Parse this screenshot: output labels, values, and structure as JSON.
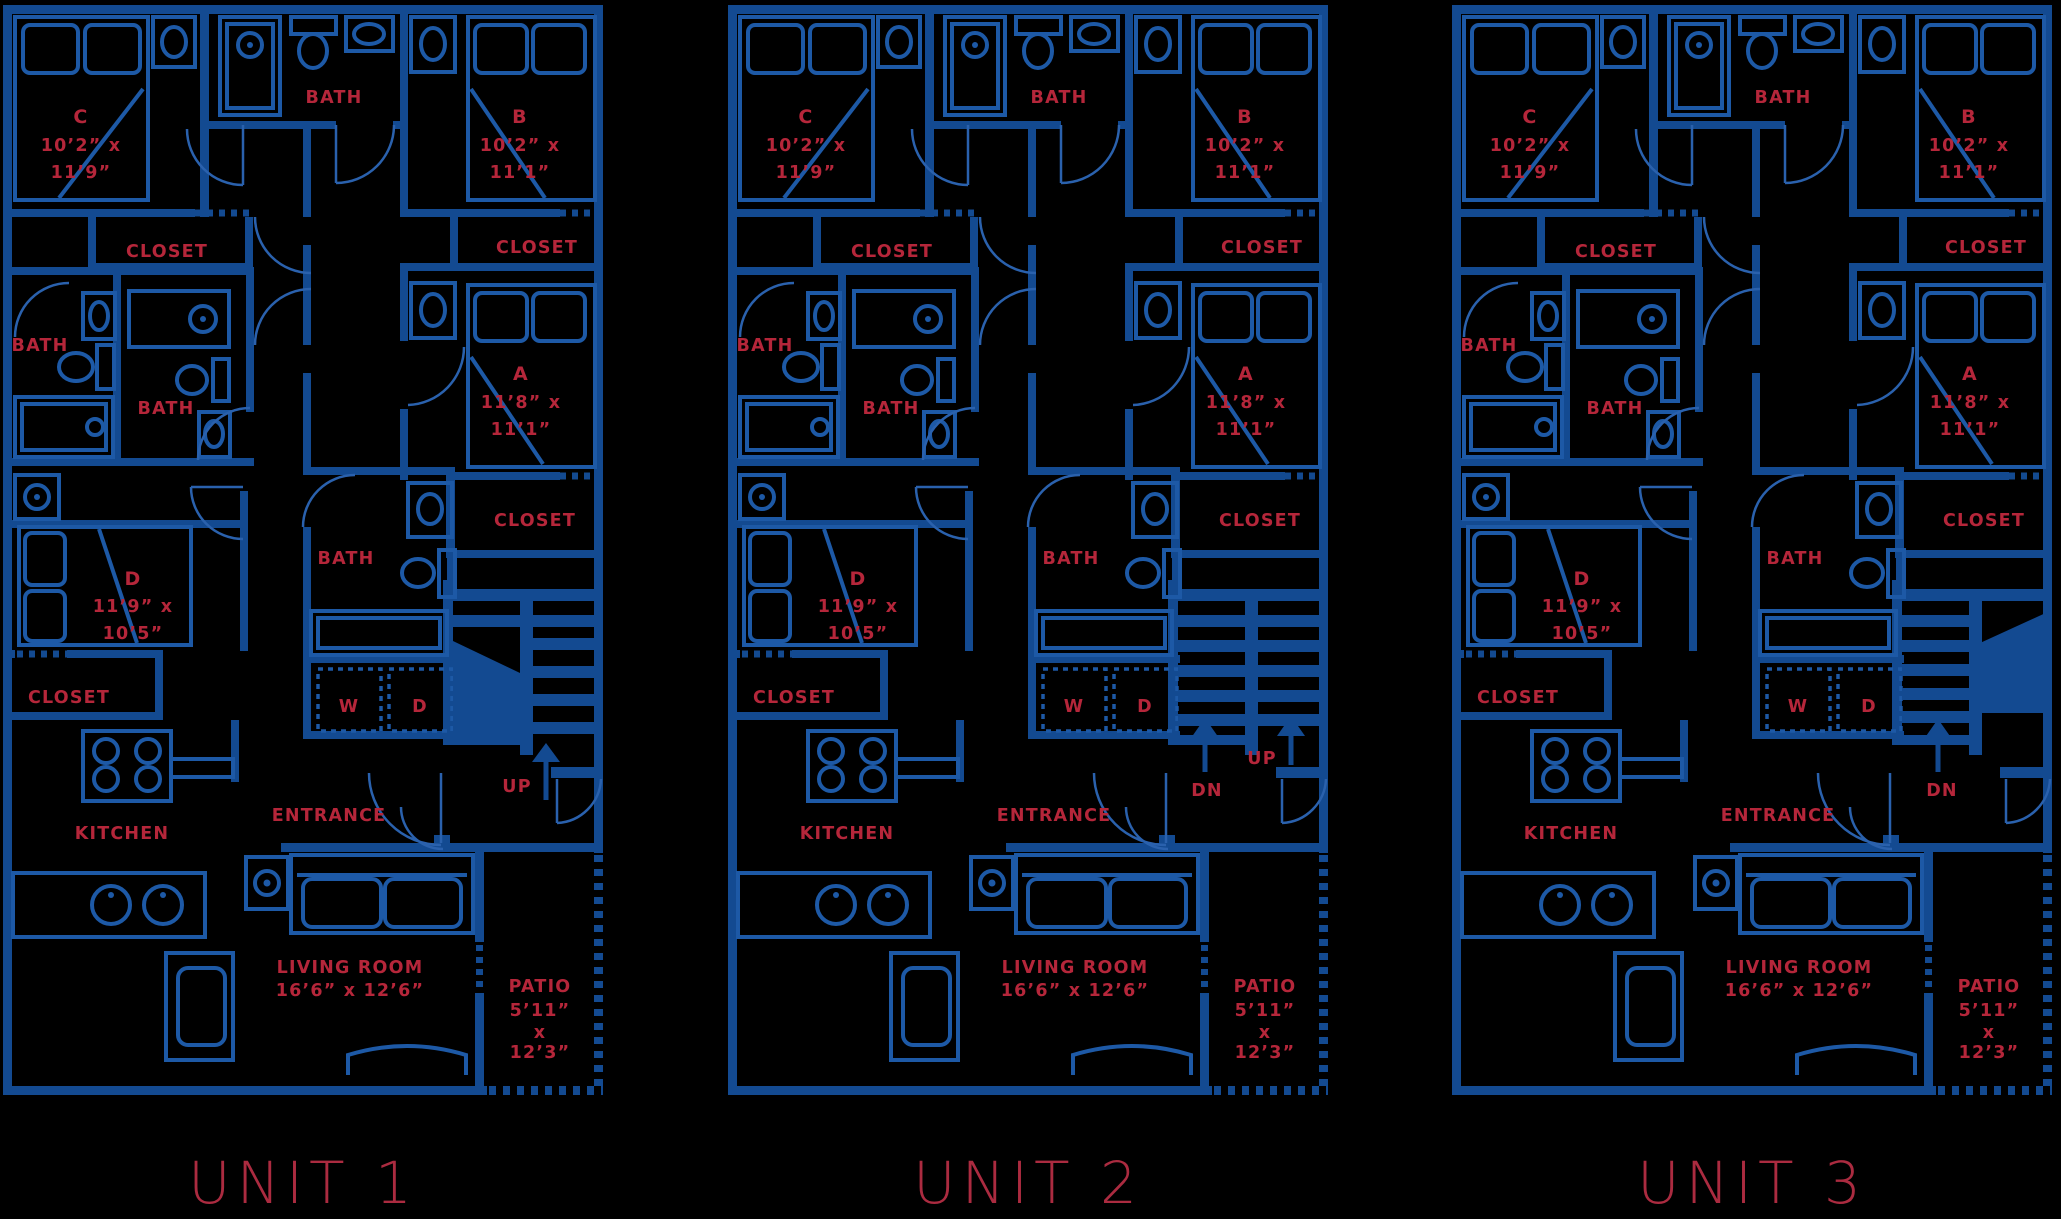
{
  "colors": {
    "background": "#000000",
    "wall": "#134a91",
    "fixture": "#1d59a6",
    "door": "#2a61ad",
    "label": "#b5263a",
    "title": "#ab2b40"
  },
  "plan": {
    "bedroom_c": {
      "lines": [
        "C",
        "10’2” x",
        "11’9”"
      ]
    },
    "bath_top": {
      "label": "BATH"
    },
    "bedroom_b": {
      "lines": [
        "B",
        "10’2” x",
        "11’1”"
      ]
    },
    "closet_left": {
      "label": "CLOSET"
    },
    "closet_right": {
      "label": "CLOSET"
    },
    "bath_left": {
      "label": "BATH"
    },
    "bath_mid": {
      "label": "BATH"
    },
    "bedroom_a": {
      "lines": [
        "A",
        "11’8” x",
        "11’1”"
      ]
    },
    "closet_a": {
      "label": "CLOSET"
    },
    "bedroom_d": {
      "lines": [
        "D",
        "11’9” x",
        "10’5”"
      ]
    },
    "bath_d": {
      "label": "BATH"
    },
    "closet_d": {
      "label": "CLOSET"
    },
    "washer": {
      "label": "W"
    },
    "dryer": {
      "label": "D"
    },
    "entrance": {
      "label": "ENTRANCE"
    },
    "kitchen": {
      "label": "KITCHEN"
    },
    "living_room": {
      "lines": [
        "LIVING ROOM",
        "16’6” x 12’6”"
      ]
    },
    "patio": {
      "lines": [
        "PATIO",
        "5’11”",
        "x",
        "12’3”"
      ]
    }
  },
  "units": [
    {
      "title": "UNIT 1",
      "stairs": {
        "labels": [
          {
            "text": "UP"
          }
        ]
      }
    },
    {
      "title": "UNIT 2",
      "stairs": {
        "labels": [
          {
            "text": "DN"
          },
          {
            "text": "UP"
          }
        ]
      }
    },
    {
      "title": "UNIT 3",
      "stairs": {
        "labels": [
          {
            "text": "DN"
          }
        ]
      }
    }
  ]
}
